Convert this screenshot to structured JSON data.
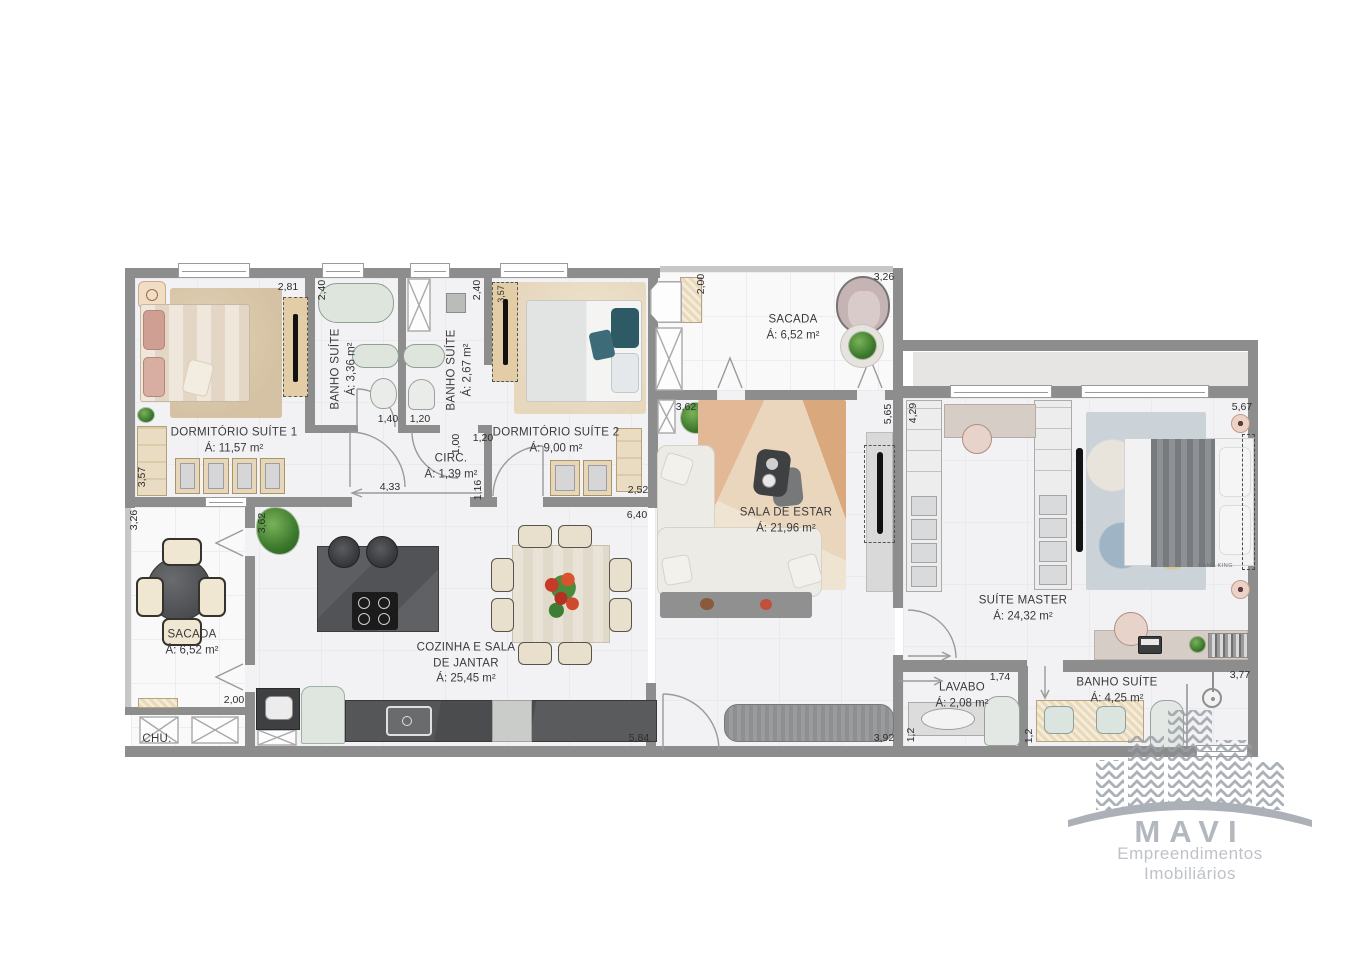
{
  "watermark": {
    "brand": "MAVI",
    "tagline": "Empreendimentos Imobiliários"
  },
  "colors": {
    "wall": "#8d8d8d",
    "wood": "#e9dcc2",
    "dark_counter": "#57585a",
    "logo_gray": "#a3a9b1"
  },
  "rooms": {
    "dorm1": {
      "name": "DORMITÓRIO SUÍTE 1",
      "area": "Á: 11,57 m²"
    },
    "banho1": {
      "name": "BANHO SUÍTE",
      "area": "Á: 3,36 m²"
    },
    "banho2": {
      "name": "BANHO SUÍTE",
      "area": "Á: 2,67 m²"
    },
    "dorm2": {
      "name": "DORMITÓRIO  SUÍTE 2",
      "area": "Á: 9,00 m²"
    },
    "circ": {
      "name": "CIRC.",
      "area": "Á: 1,39 m²"
    },
    "sacada_top": {
      "name": "SACADA",
      "area": "Á: 6,52 m²"
    },
    "sala": {
      "name": "SALA DE ESTAR",
      "area": "Á: 21,96 m²"
    },
    "suite_master": {
      "name": "SUÍTE MASTER",
      "area": "Á: 24,32 m²",
      "bed_tag": "CAMA KING"
    },
    "sacada_left": {
      "name": "SACADA",
      "area": "Á: 6,52 m²"
    },
    "cozinha": {
      "name": "COZINHA E SALA",
      "name2": "DE JANTAR",
      "area": "Á: 25,45 m²"
    },
    "lavabo": {
      "name": "LAVABO",
      "area": "Á: 2,08 m²"
    },
    "banho_master": {
      "name": "BANHO SUÍTE",
      "area": "Á: 4,25 m²"
    },
    "chu": {
      "name": "CHU."
    }
  },
  "dims": {
    "d_dorm1_top": "2,81",
    "d_banho1_top": "2,40",
    "d_banho2_top": "2,40",
    "d_dorm2_ward": "3,57",
    "d_sacada1_left": "2,00",
    "d_sacada1_top": "3,26",
    "d_dorm1_left": "3,57",
    "d_banho1_w": "1,40",
    "d_banho2_w": "1,20",
    "d_circ_h": "1,00",
    "d_circ_w": "1,20",
    "d_circ_len": "4,33",
    "d_dorm2_door": "1,16",
    "d_dorm2_w": "2,52",
    "d_sala_top": "3,62",
    "d_sala_right": "5,65",
    "d_suite_left": "4,29",
    "d_suite_top": "5,67",
    "d_sacada2_top": "3,26",
    "d_cozinha_left": "3,62",
    "d_sacada2_bot": "2,00",
    "d_cozinha_top": "6,40",
    "d_cozinha_bot": "5,84",
    "d_hall": "3,92",
    "d_lavabo_top": "1,74",
    "d_lavabo_left": "1,2",
    "d_banho3_top": "3,77",
    "d_banho3_left": "1,2"
  }
}
